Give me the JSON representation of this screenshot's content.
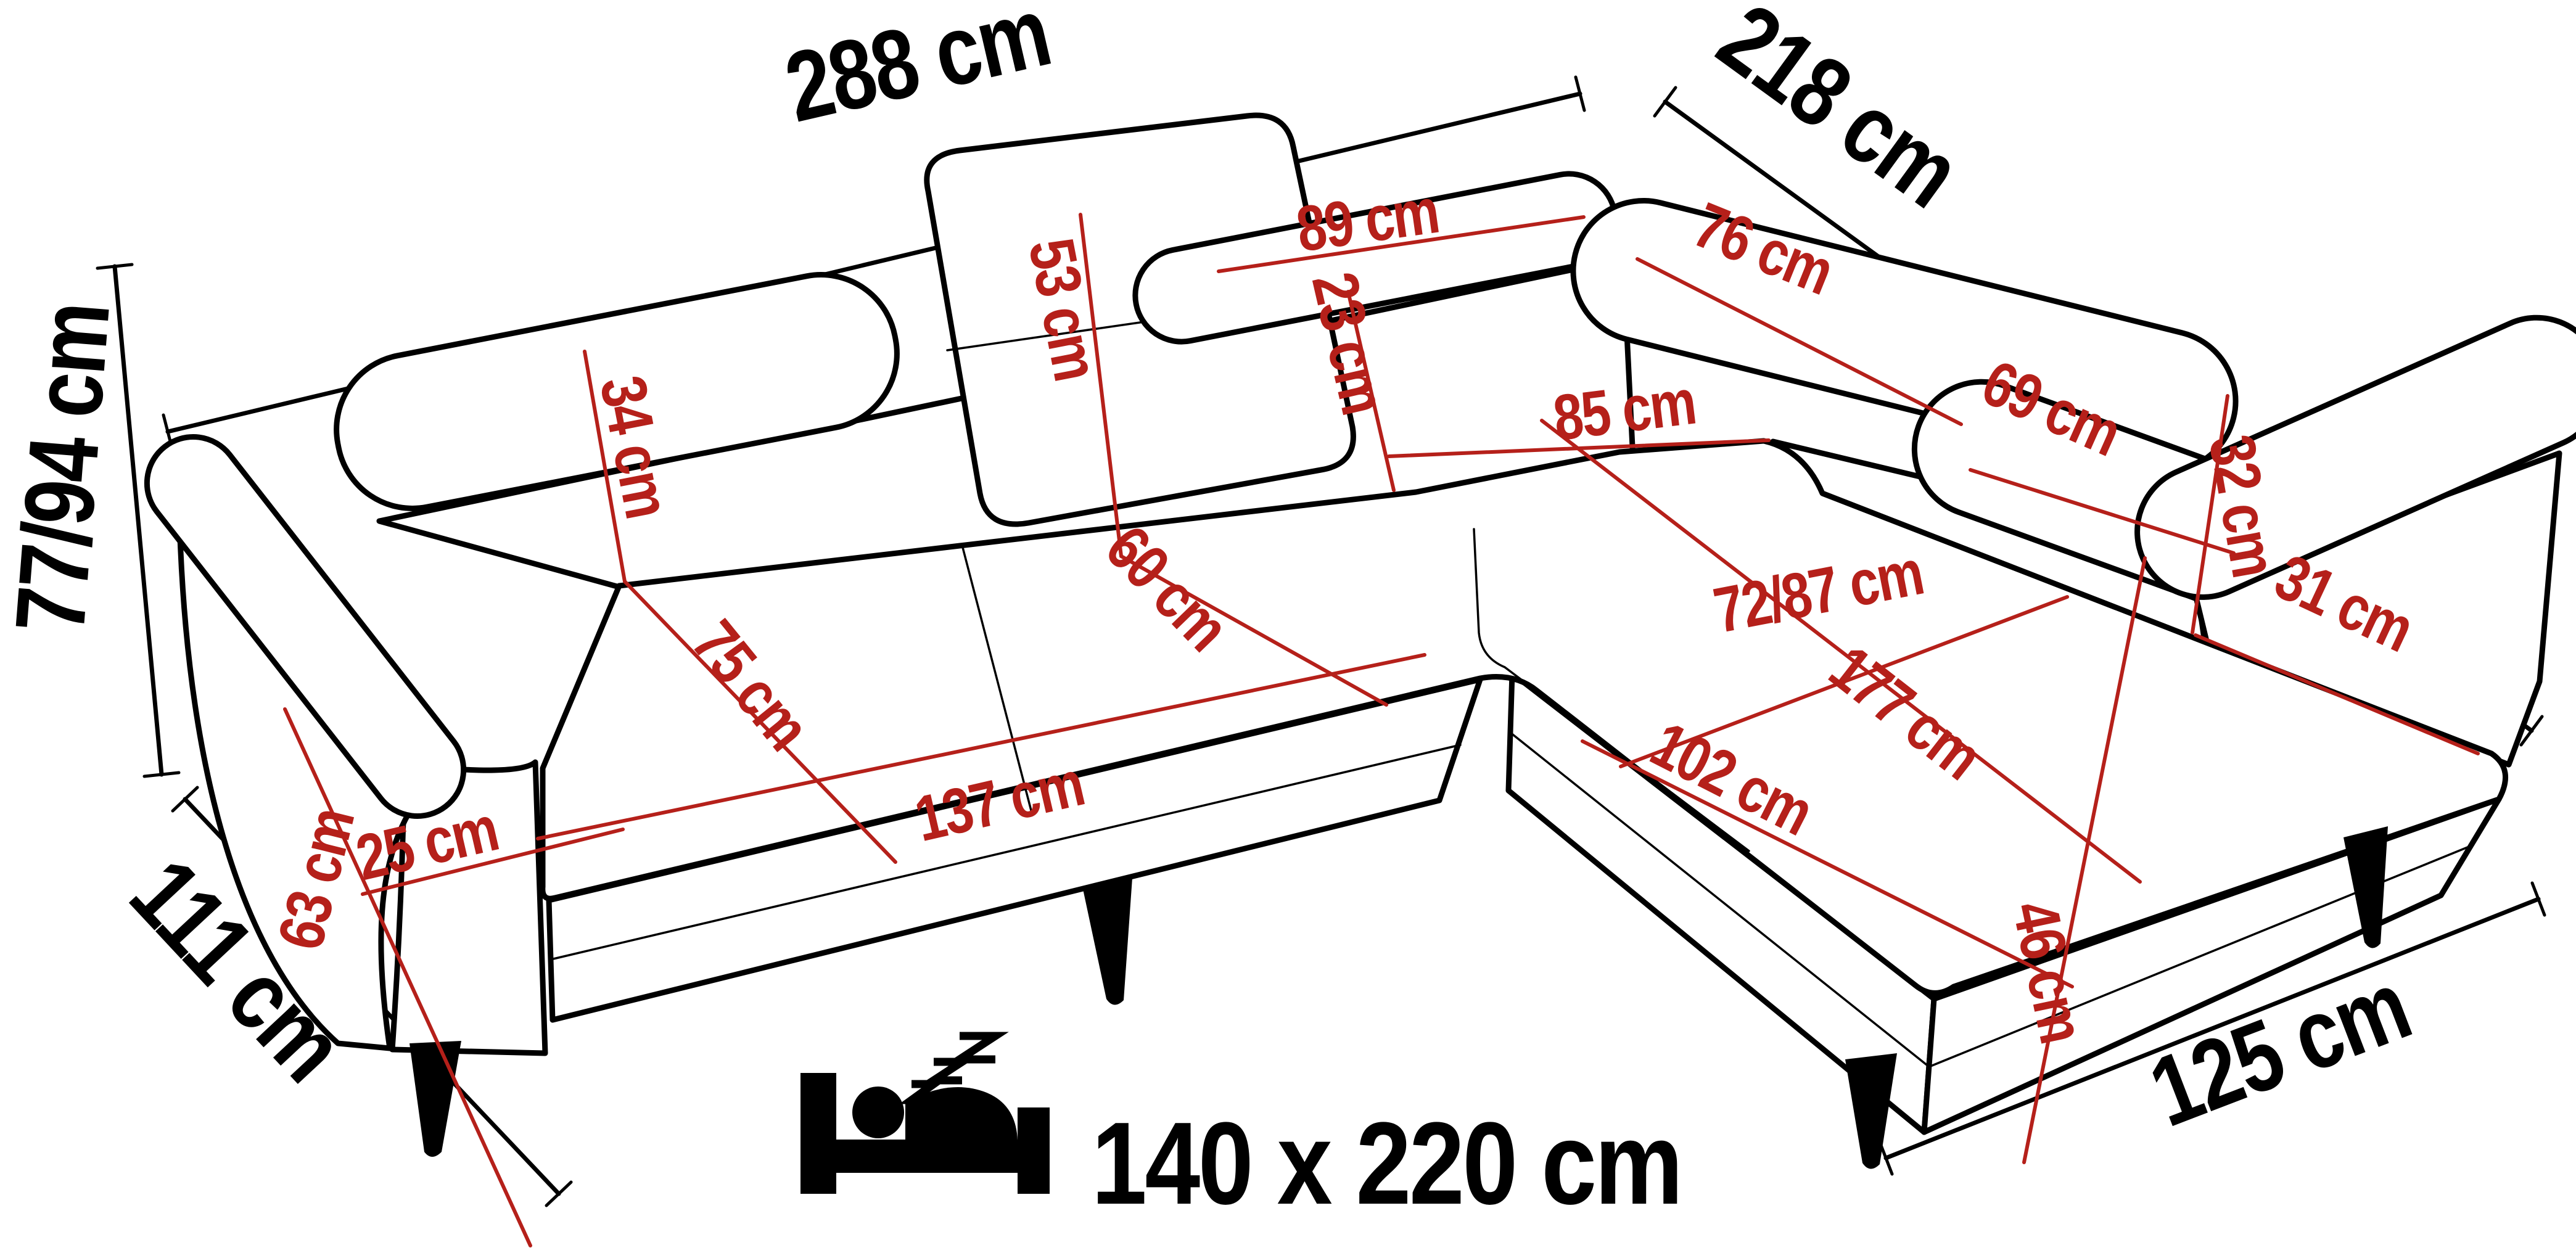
{
  "colors": {
    "background": "#ffffff",
    "outline": "#000000",
    "dimension_text": "#000000",
    "measurement": "#b5201a"
  },
  "overall": {
    "width": "288 cm",
    "depth_right": "218 cm",
    "height": "77/94 cm",
    "depth_left": "111 cm",
    "chaise_end_width": "125 cm"
  },
  "measures": {
    "back_cushion_left": "89 cm",
    "back_cushion_corner": "76 cm",
    "back_cushion_right": "69 cm",
    "center_backrest_height": "53 cm",
    "headrest_height": "34 cm",
    "back_gap": "23 cm",
    "corner_span": "85 cm",
    "seat_depth_left": "75 cm",
    "seat_depth_center": "60 cm",
    "chaise_seat_depth": "72/87 cm",
    "seat_width": "137 cm",
    "chaise_length": "177 cm",
    "chaise_cushion_length": "102 cm",
    "arm_cushion_height": "32 cm",
    "arm_gap": "31 cm",
    "arm_front_height": "63 cm",
    "arm_width": "25 cm",
    "base_height": "46 cm"
  },
  "sleeping_area": {
    "icon": "sleeping-bed-icon",
    "size": "140 x 220 cm"
  }
}
